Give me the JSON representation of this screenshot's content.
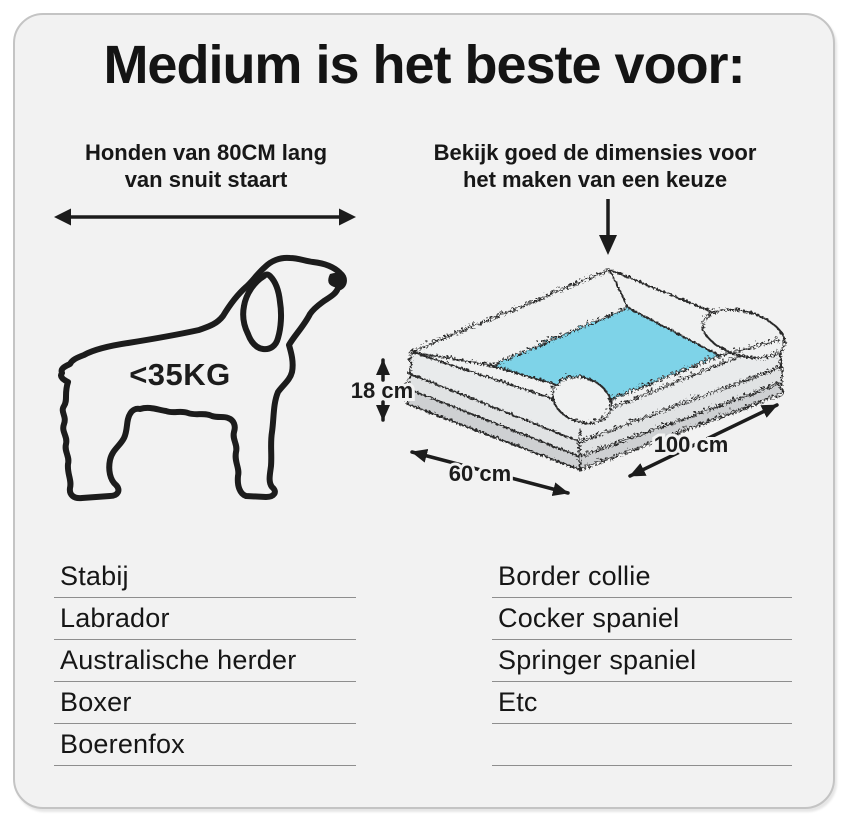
{
  "page": {
    "background": "#ffffff"
  },
  "card": {
    "background": "#f2f2f2",
    "border_color": "#c4c4c4",
    "title": "Medium is het beste voor:",
    "left_section": {
      "subtitle_line1": "Honden van 80CM lang",
      "subtitle_line2": "van snuit staart",
      "weight_label": "<35KG",
      "icon": "dog-outline-icon",
      "arrow_icon": "length-double-arrow-icon"
    },
    "right_section": {
      "subtitle_line1": "Bekijk goed de dimensies voor",
      "subtitle_line2": "het maken van een keuze",
      "arrow_icon": "pointer-down-arrow-icon",
      "icon": "dog-bed-isometric-icon",
      "bed": {
        "cushion_color": "#7ed3e8",
        "bolster_color": "#f0f1f1",
        "base_color": "#ced0d2",
        "height_label": "18 cm",
        "width_label": "60 cm",
        "length_label": "100 cm"
      }
    },
    "breeds_left": [
      "Stabij",
      "Labrador",
      "Australische herder",
      "Boxer",
      "Boerenfox"
    ],
    "breeds_right": [
      "Border collie",
      "Cocker spaniel",
      "Springer spaniel",
      "Etc",
      ""
    ]
  }
}
